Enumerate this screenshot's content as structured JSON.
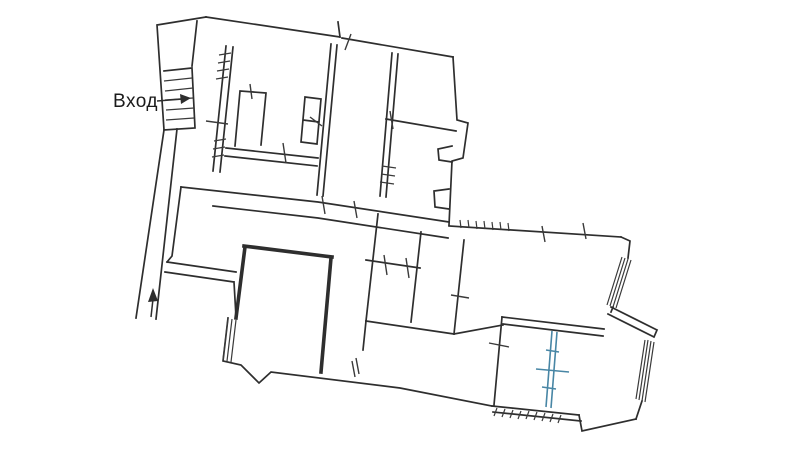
{
  "document": {
    "type": "scanned floor plan drawing",
    "background": "#ffffff"
  },
  "labels": {
    "entrance": "Вход"
  },
  "colors": {
    "ink": "#2e2e2e",
    "ink_light": "#3a3a3a",
    "partition_blue": "#4886a5",
    "label_text": "#1b1b1b",
    "background": "#ffffff"
  },
  "icons": [
    {
      "name": "stair-direction-arrow",
      "meaning": "arrow across staircase treads pointing right (up the stairs)"
    },
    {
      "name": "corridor-direction-arrow",
      "meaning": "arrow in left corridor pointing up"
    }
  ],
  "features": {
    "staircase": "entrance staircase with tread lines, top-left",
    "corridor": "long diagonal corridor on the left side",
    "rooms": "cluster of interconnected rooms with double-line walls and door tick marks",
    "windows": "hatched window bands on right and left exterior walls",
    "blue_partition": "blue double-line partition with cross ticks in lower-right room",
    "exterior_hatching": "short hatch ticks along lower-right and upper-right exterior walls"
  }
}
